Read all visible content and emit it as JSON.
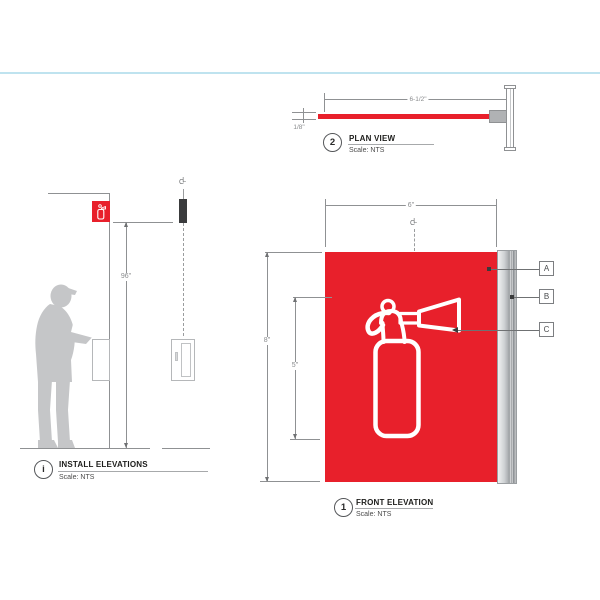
{
  "canvas": {
    "width": 600,
    "height": 600,
    "background": "#ffffff"
  },
  "accent_rule_color": "#bfe3ef",
  "colors": {
    "sign_red": "#e8202b",
    "icon_white": "#ffffff",
    "silhouette_gray": "#c5c6c8",
    "line_gray": "#8f9193",
    "dim_text_gray": "#8a8c8e",
    "label_text": "#1d1d1b",
    "rail_light": "#f0f1f2",
    "rail_dark": "#8f9396",
    "bracket_gray": "#b0b2b4",
    "sign_edge_dark": "#3a3b3c"
  },
  "plan_view": {
    "number": "2",
    "title": "PLAN VIEW",
    "scale": "Scale: NTS",
    "width_dim": "6-1/2\"",
    "thickness_dim": "1/8\""
  },
  "install_elevations": {
    "number": "i",
    "title": "INSTALL ELEVATIONS",
    "scale": "Scale: NTS",
    "height_dim": "96\"",
    "centerline": {
      "c": "C",
      "l": "L"
    }
  },
  "front_elevation": {
    "number": "1",
    "title": "FRONT ELEVATION",
    "scale": "Scale: NTS",
    "width_dim": "6\"",
    "height_dim": "8\"",
    "icon_height_dim": "5\"",
    "centerline": {
      "c": "C",
      "l": "L"
    },
    "callouts": [
      {
        "tag": "A"
      },
      {
        "tag": "B"
      },
      {
        "tag": "C"
      }
    ]
  }
}
